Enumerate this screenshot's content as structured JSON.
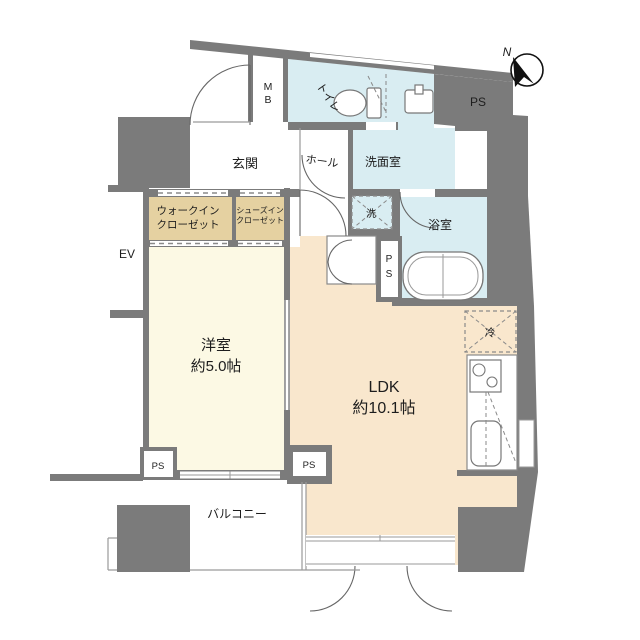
{
  "plan": {
    "type": "apartment-floor-plan",
    "colors": {
      "wall": "#7b7b7b",
      "wet_room": "#d9edf2",
      "closet": "#e5d1a1",
      "bedroom": "#fcf9e4",
      "ldk": "#f9e7cd",
      "outline": "#555555"
    },
    "rooms": {
      "entrance": "玄関",
      "hall": "ホール",
      "toilet": "トイレ",
      "washroom": "洗面室",
      "bathroom": "浴室",
      "washer": "洗",
      "fridge": "冷",
      "walk_in_closet_1": "ウォークイン",
      "walk_in_closet_2": "クローゼット",
      "shoes_closet_1": "シューズイン",
      "shoes_closet_2": "クローゼット",
      "bedroom": "洋室",
      "bedroom_size": "約5.0帖",
      "ldk": "LDK",
      "ldk_size": "約10.1帖",
      "balcony": "バルコニー"
    },
    "labels": {
      "mb_m": "M",
      "mb_b": "B",
      "ps": "PS",
      "ps_p": "P",
      "ps_s": "S",
      "ev": "EV",
      "north": "N"
    }
  }
}
